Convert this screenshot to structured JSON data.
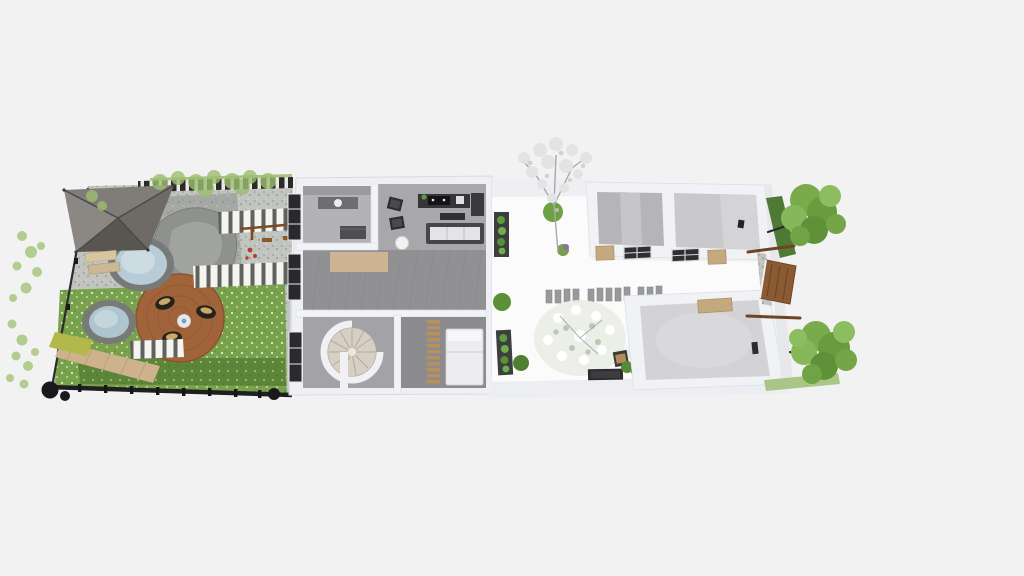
{
  "app": {
    "type": "floor-plan-3d-render",
    "background": "#f2f2f3"
  },
  "labels": {
    "scene": "Top-down 3D render of a long narrow residence: zen garden, main house, inner courtyard, rear annex rooms",
    "garden": "Zen garden with pergola, ponds, rock and round timber deck",
    "pergola": "Gray canvas pergola canopy",
    "pond_upper": "Upper stone-edged pond",
    "pond_lower": "Lower stone-edged pond",
    "deck": "Round timber deck with floor cushions and small table",
    "bathroom": "Bathroom with vanity and mirror wall",
    "living_room": "Living room with sofa, coffee table and kitchen counter",
    "hall": "Central hall with plank floor and rug",
    "spiral_staircase": "Spiral staircase",
    "bedroom": "Bedroom with double bed and slatted wood screen",
    "courtyard": "Inner courtyard with blossom trees, planters and stepping stones",
    "annex_room_1": "Annex room one (empty, concrete floor)",
    "annex_room_2": "Annex room two (empty, concrete floor)",
    "annex_room_3": "Rear annex room (empty)",
    "entrance_door": "Rear entrance wooden door",
    "tent": "Small white canopy tent with chair",
    "trees_right": "Green trees along rear boundary",
    "fence": "Dark boundary fence with posts"
  },
  "palette": {
    "background": "#f2f2f3",
    "wall": "#f1f2f5",
    "wall_shade": "#e2e5ea",
    "floor_hall": "#919194",
    "floor_living": "#a8a8ab",
    "floor_bedroom": "#8c8c8f",
    "courtyard_floor": "#fbfbfc",
    "grass": "#79a24c",
    "grass_dark": "#5d8537",
    "gravel": "#c2c4c0",
    "water": "#b7ccd6",
    "deck_wood": "#a0633a",
    "canopy_gray": "#6e6a66",
    "door_wood": "#8a5b33",
    "door_tan": "#c4a87e",
    "tree_green": "#79ab4a",
    "blossom_white": "#e9ede6",
    "fence_black": "#1f1f21",
    "window_frame": "#2a2a2d"
  }
}
